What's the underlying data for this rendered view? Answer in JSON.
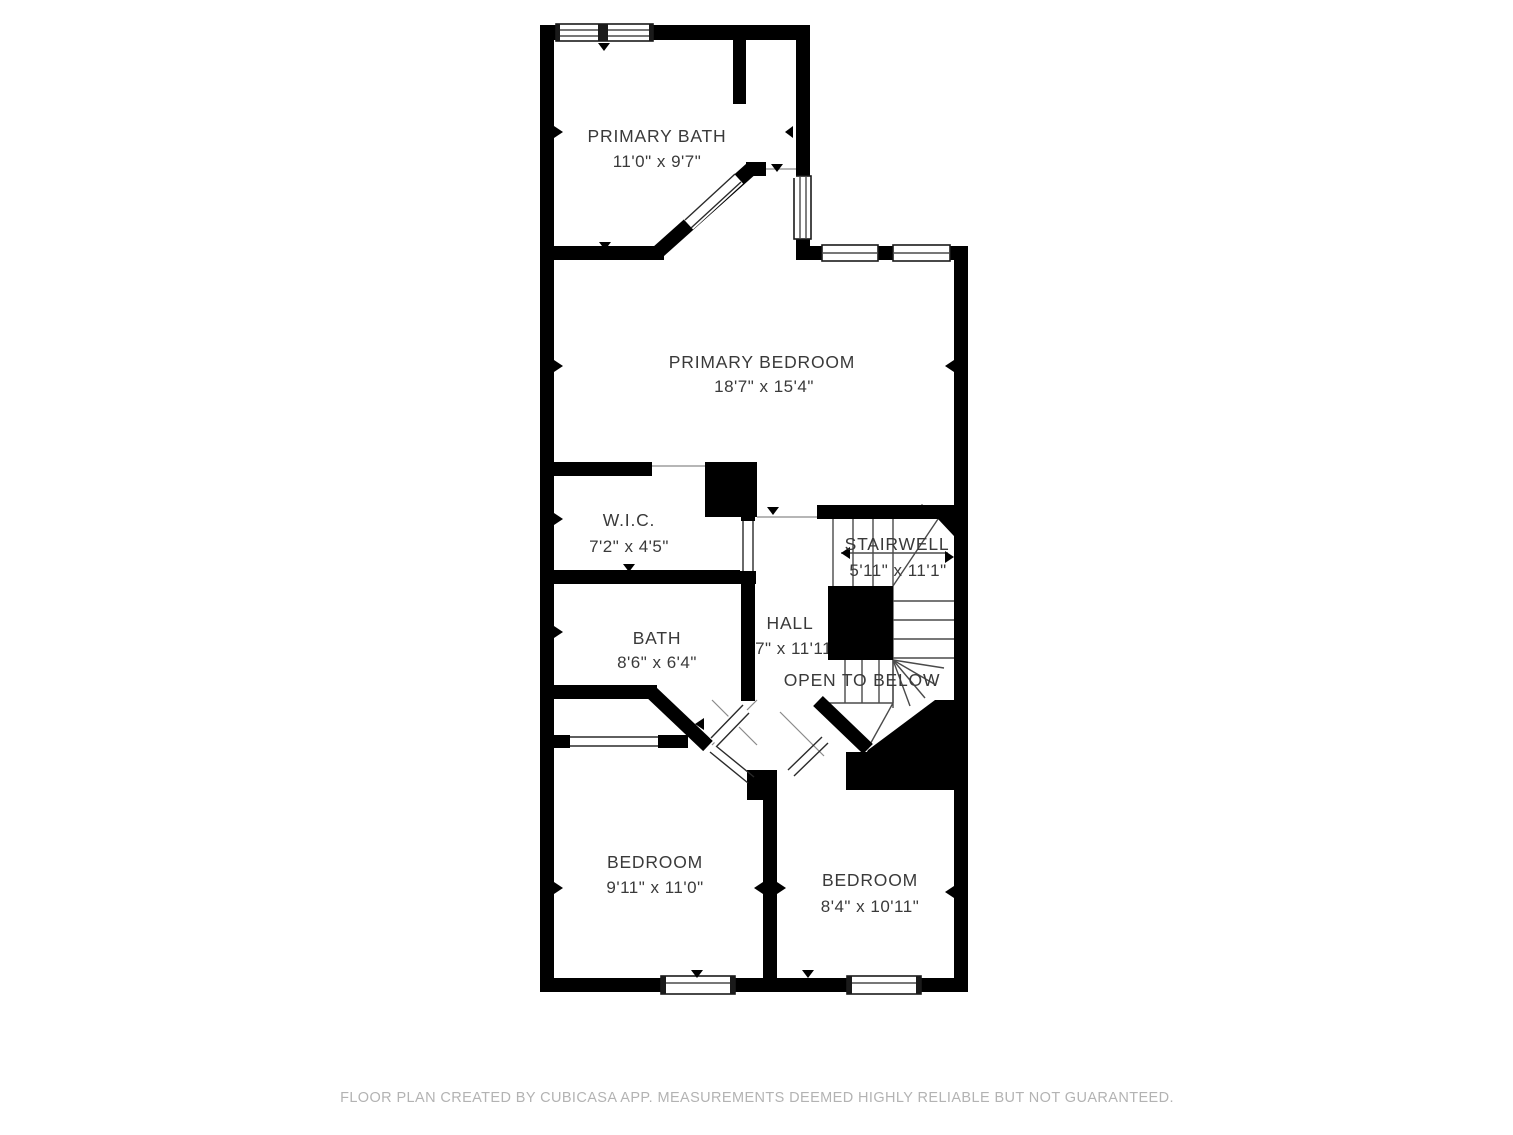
{
  "title": "Second floor plan",
  "floor_plan": {
    "rooms": [
      {
        "name": "PRIMARY BATH",
        "dimensions": "11'0\" x 9'7\""
      },
      {
        "name": "PRIMARY BEDROOM",
        "dimensions": "18'7\" x 15'4\""
      },
      {
        "name": "W.I.C.",
        "dimensions": "7'2\" x 4'5\""
      },
      {
        "name": "STAIRWELL",
        "dimensions": "5'11\" x 11'1\""
      },
      {
        "name": "BATH",
        "dimensions": "8'6\" x 6'4\""
      },
      {
        "name": "HALL",
        "dimensions": "4'7\" x 11'11\""
      },
      {
        "name": "OPEN TO BELOW",
        "dimensions": ""
      },
      {
        "name": "BEDROOM",
        "dimensions": "9'11\" x 11'0\""
      },
      {
        "name": "BEDROOM",
        "dimensions": "8'4\" x 10'11\""
      }
    ],
    "colors": {
      "wall": "#000000",
      "floor": "#ffffff",
      "label_text": "#3a3a3a",
      "footer_text": "#b3b3b3"
    }
  },
  "footer": {
    "disclaimer": "FLOOR PLAN CREATED BY CUBICASA APP. MEASUREMENTS DEEMED HIGHLY RELIABLE BUT NOT GUARANTEED."
  }
}
